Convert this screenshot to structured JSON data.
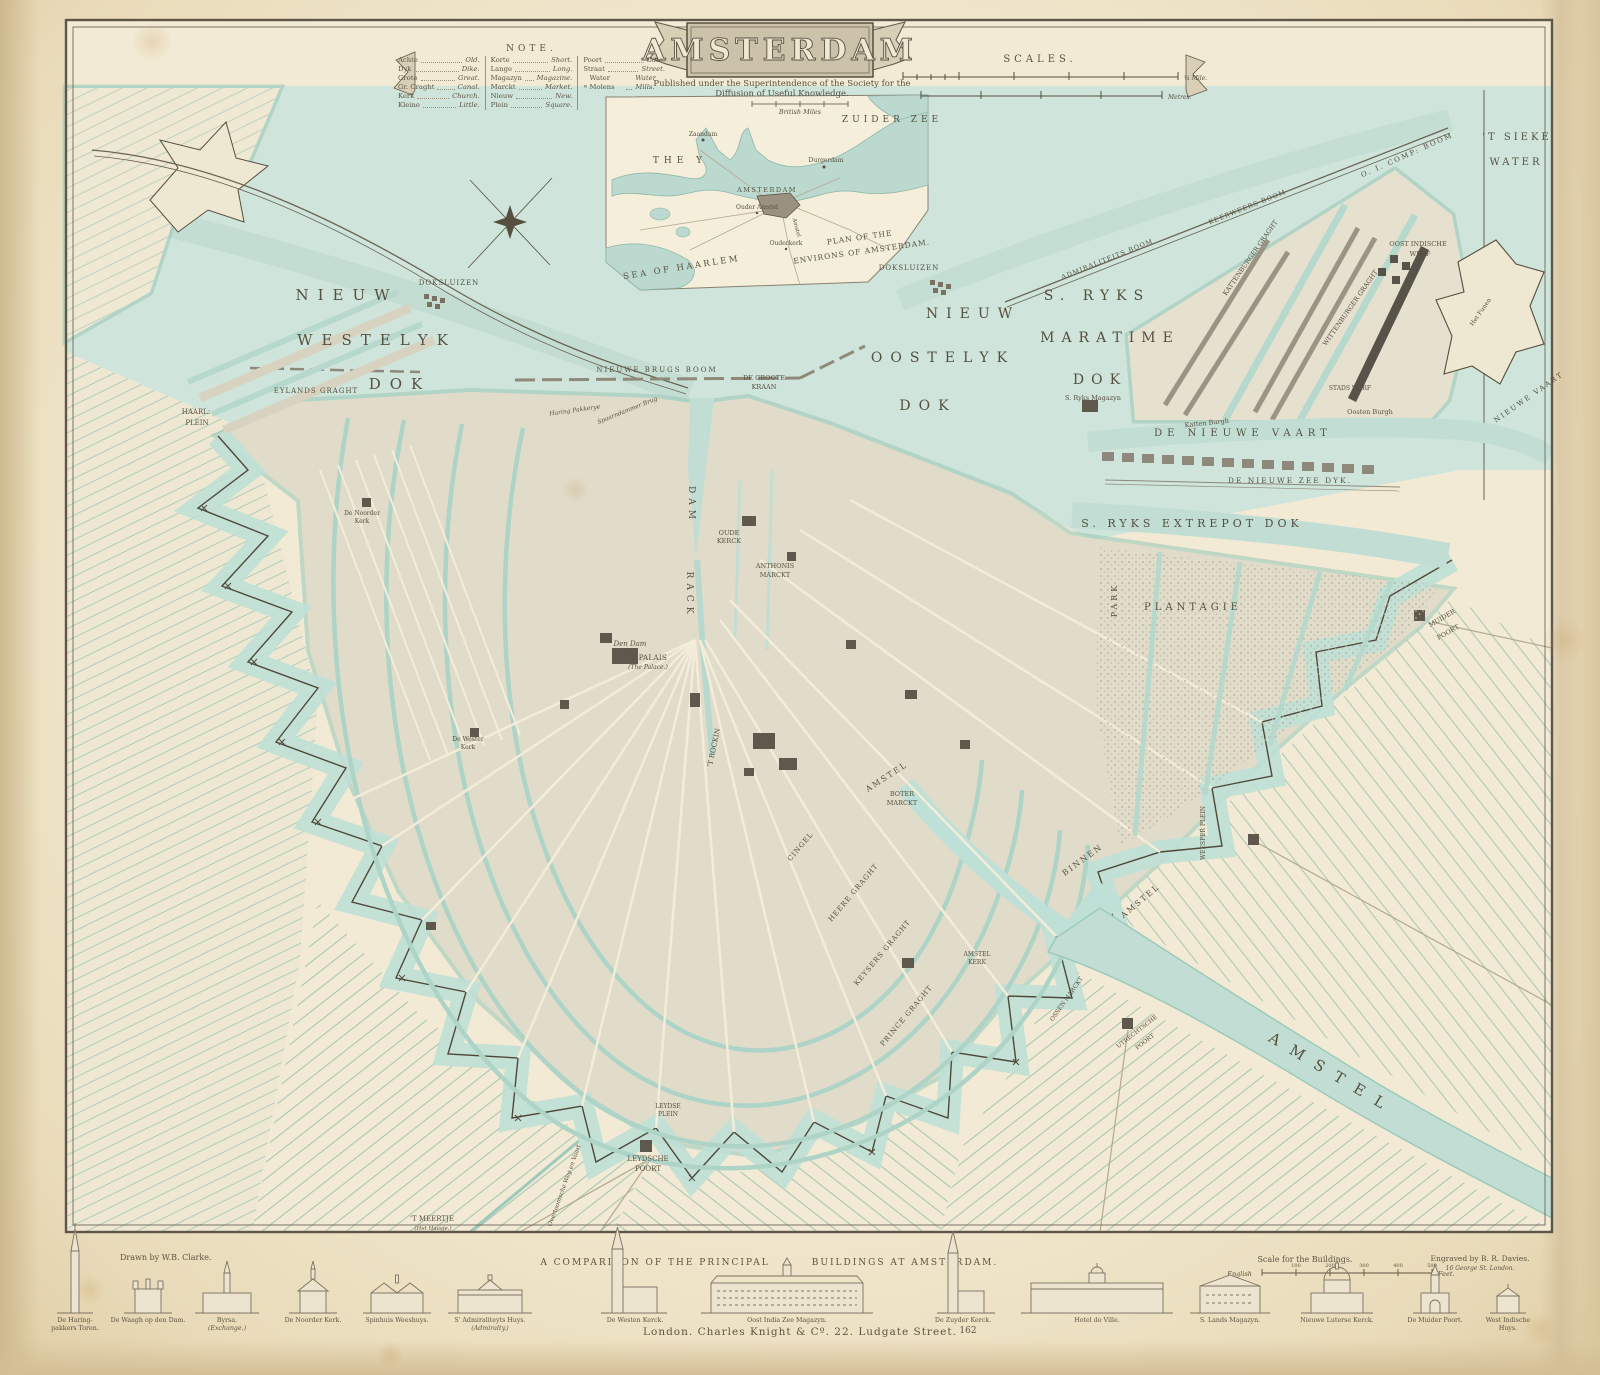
{
  "cartouche": {
    "title": "AMSTERDAM",
    "publisher_line1": "Published under the Superintendence of the Society for the",
    "publisher_line2": "Diffusion of Useful Knowledge."
  },
  "note": {
    "heading": "NOTE.",
    "col1": [
      {
        "term": "Achte",
        "def": "Old."
      },
      {
        "term": "Dyk",
        "def": "Dike."
      },
      {
        "term": "Grote",
        "def": "Great."
      },
      {
        "term": "Gr. Graght",
        "def": "Canal."
      },
      {
        "term": "Kerk",
        "def": "Church."
      },
      {
        "term": "Kleine",
        "def": "Little."
      }
    ],
    "col2": [
      {
        "term": "Korte",
        "def": "Short."
      },
      {
        "term": "Lange",
        "def": "Long."
      },
      {
        "term": "Magazyn",
        "def": "Magazine."
      },
      {
        "term": "Marckt",
        "def": "Market."
      },
      {
        "term": "Nieuw",
        "def": "New."
      },
      {
        "term": "Plein",
        "def": "Square."
      }
    ],
    "col3": [
      {
        "term": "Poort",
        "def": "Gate."
      },
      {
        "term": "Straat",
        "def": "Street."
      },
      {
        "term": "Water Molens",
        "def": "Water Mills."
      }
    ]
  },
  "scales": {
    "heading": "SCALES.",
    "bar1_end": "¾ Mile.",
    "bar2_end": "Metres.",
    "miles_label": "British Miles"
  },
  "inset": {
    "zuider_zee": "ZUIDER  ZEE",
    "the_y": "THE   Y",
    "amsterdam": "AMSTERDAM",
    "zaandam": "Zaandam",
    "durgerdam": "Durgerdam",
    "ouder_amstel": "Ouder Amstel",
    "ouderkerk": "Ouderkerk",
    "amstel_river": "Amstel",
    "plan_line1": "PLAN OF THE",
    "plan_line2": "ENVIRONS OF AMSTERDAM.",
    "sea_of_haarlem": "SEA  OF  HAARLEM"
  },
  "map": {
    "labels": {
      "nw1": "NIEUW",
      "nw2": "WESTELYK",
      "nw3": "DOK",
      "no1": "NIEUW",
      "no2": "OOSTELYK",
      "no3": "DOK",
      "sr1": "S. RYKS",
      "sr2": "MARATIME",
      "sr3": "DOK",
      "sieke1": "'T SIEKE",
      "sieke2": "WATER",
      "vaart": "DE  NIEUWE  VAART",
      "zeedyk": "DE  NIEUWE  ZEE  DYK.",
      "entrepot": "S.  RYKS   EXTREPOT   DOK",
      "plantagie": "PLANTAGIE",
      "park": "PARK",
      "amstel_big": "AMSTEL",
      "dam": "DAM",
      "rack": "RACK",
      "haarl1": "HAARL:",
      "haarl2": "PLEIN",
      "eylands": "EYLANDS  GRAGHT",
      "doksl_w": "DOKSLUIZEN",
      "doksl_e": "DOKSLUIZEN",
      "brugsboom": "NIEUWE  BRUGS  BOOM",
      "groote1": "DE GROOTE",
      "groote2": "KRAAN",
      "oude1": "OUDE",
      "oude2": "KERCK",
      "anth1": "ANTHONIS",
      "anth2": "MARCKT",
      "dendam": "Den Dam",
      "palais": "'T PALAIS",
      "palais_sub": "(The Palace.)",
      "rockin": "'T ROCKIN",
      "boter1": "BOTER",
      "boter2": "MARCKT",
      "amstel_in": "AMSTEL",
      "binnen1": "BINNEN",
      "binnen2": "AMSTEL",
      "heere": "HEERE GRAGHT",
      "keysers": "KEYSERS GRAGHT",
      "prince": "PRINCE GRAGHT",
      "cingel": "CINGEL",
      "amstelkerk1": "AMSTEL",
      "amstelkerk2": "KERK",
      "ossen": "OSSEN MARCKT",
      "utrecht1": "UTRECHTSCHE",
      "utrecht2": "POORT",
      "weesper": "WEESPER PLEIN",
      "leydse1": "LEYDSE",
      "leydse2": "PLEIN",
      "leydsche1": "LEYDSCHE",
      "leydsche2": "POORT",
      "meertje": "'T MEERTJE",
      "meertje_sub": "(Het Haasje.)",
      "overtoom": "Overtoomsche Weg en Vaart",
      "muider1": "MUIDER",
      "muider2": "POORT",
      "ryksmag": "S. Ryks Magazyn",
      "katten": "Katten Burgh",
      "oosten": "Oosten Burgh",
      "stadswerf": "STADS WERF",
      "oiwerf1": "OOST INDISCHE",
      "oiwerf2": "WERF",
      "kattgracht": "KATTENBURGER GRAGHT",
      "wittgracht": "WITTENBURGER GRAGHT",
      "oiboom": "O. I. COMP: BOOM",
      "admboom": "ADMIRALITEITS BOOM",
      "keerweers": "KEERWEERS BOOM",
      "funen": "Het Funen",
      "nieuwevaart_ne": "NIEUWE VAART",
      "noorder1": "De Noorder",
      "noorder2": "Kerk",
      "wester1": "De Wester",
      "wester2": "Kerk",
      "spaarn": "Spaarndammer Brug",
      "haringp": "Haring Pakkerye"
    }
  },
  "comparison": {
    "title1": "A  COMPARISON  OF  THE  PRINCIPAL",
    "title2": "BUILDINGS  AT  AMSTERDAM.",
    "scale_heading": "Scale for the Buildings.",
    "scale_lang": "English",
    "scale_feet": "Feet.",
    "ticks": {
      "t1": "100",
      "t2": "200",
      "t3": "300",
      "t4": "400",
      "t5": "500"
    },
    "buildings": [
      {
        "l1": "De Haring-",
        "l2": "pakkers Toren."
      },
      {
        "l1": "De Waagh op den Dam.",
        "l2": ""
      },
      {
        "l1": "Byrsa.",
        "l2": "(Exchange.)"
      },
      {
        "l1": "De Noorder Kerk.",
        "l2": ""
      },
      {
        "l1": "Spinhuis Weeshuys.",
        "l2": ""
      },
      {
        "l1": "S' Admiraliteyts Huys.",
        "l2": "(Admiralty.)"
      },
      {
        "l1": "De Westen Kerck.",
        "l2": ""
      },
      {
        "l1": "Oost India Zee Magazyn.",
        "l2": ""
      },
      {
        "l1": "De Zuyder Kerck.",
        "l2": ""
      },
      {
        "l1": "Hotel de Ville.",
        "l2": ""
      },
      {
        "l1": "S. Lands Magazyn.",
        "l2": ""
      },
      {
        "l1": "Nieuwe Luterse Kerck.",
        "l2": ""
      },
      {
        "l1": "De Muider Poort.",
        "l2": ""
      },
      {
        "l1": "West Indische",
        "l2": "Huys."
      }
    ]
  },
  "imprint": {
    "drawn_by": "Drawn by W.B. Clarke.",
    "engraved_by": "Engraved by B. R. Davies.",
    "engraver_address": "16 George St. London.",
    "publisher": "London. Charles Knight & Cº. 22. Ludgate Street.",
    "plate_number": "162"
  },
  "colors": {
    "paper": "#f2ead4",
    "water": "#c2ded4",
    "shore": "#9ccabb",
    "city": "#e1dcca",
    "ink": "#564e3e",
    "dark_building": "#5f594d"
  }
}
